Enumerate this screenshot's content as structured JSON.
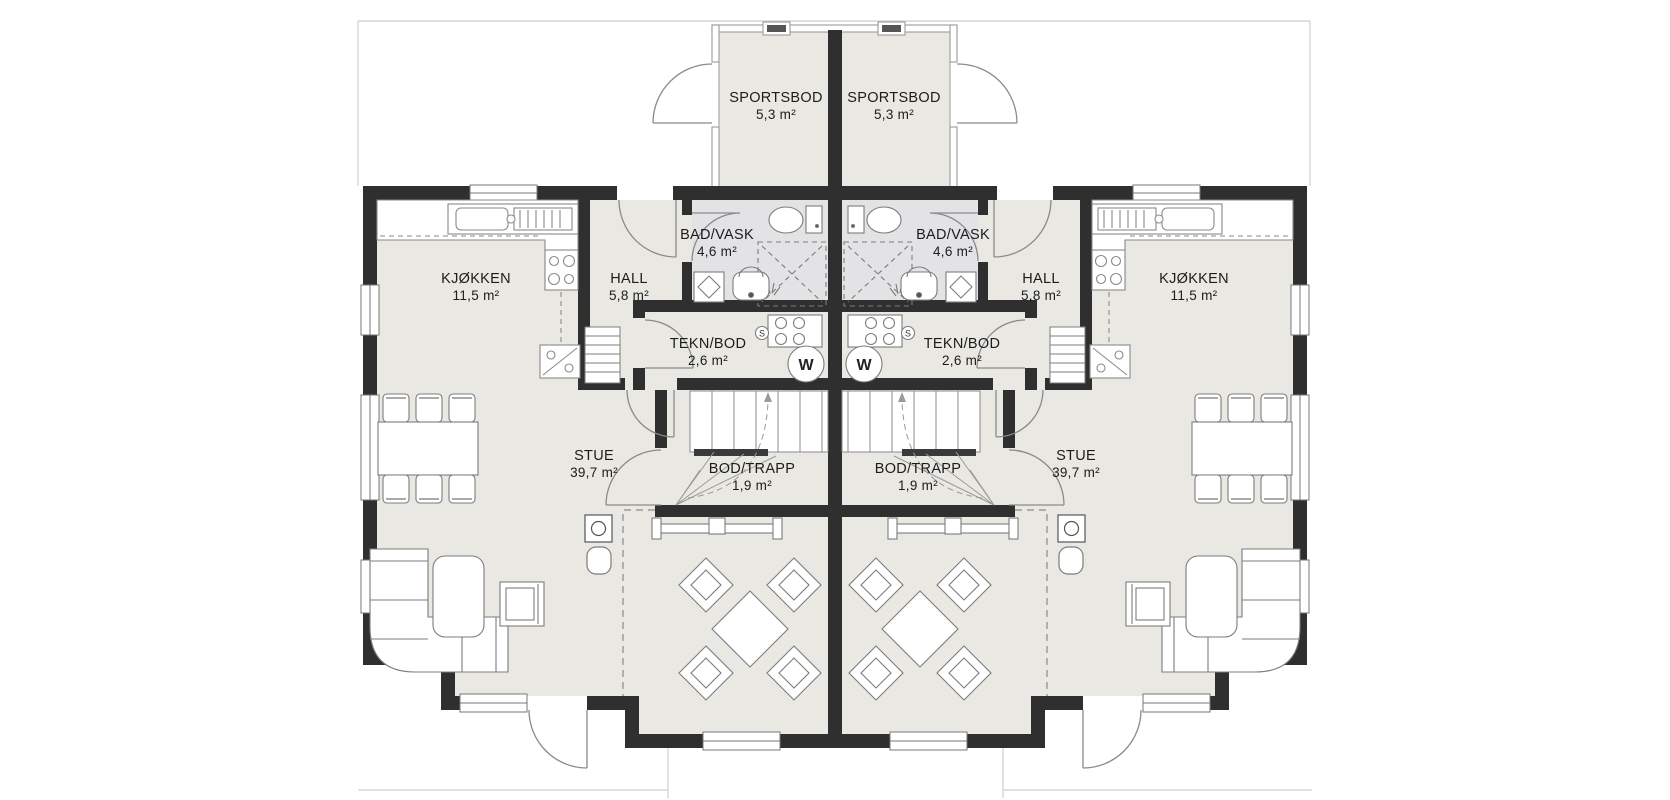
{
  "plan_type": "duplex-floor-plan",
  "units": [
    {
      "side": "left",
      "rooms": [
        {
          "name": "SPORTSBOD",
          "area": "5,3 m²"
        },
        {
          "name": "BAD/VASK",
          "area": "4,6 m²"
        },
        {
          "name": "HALL",
          "area": "5,8 m²"
        },
        {
          "name": "KJØKKEN",
          "area": "11,5 m²"
        },
        {
          "name": "TEKN/BOD",
          "area": "2,6 m²"
        },
        {
          "name": "BOD/TRAPP",
          "area": "1,9 m²"
        },
        {
          "name": "STUE",
          "area": "39,7 m²"
        }
      ]
    },
    {
      "side": "right",
      "rooms": [
        {
          "name": "SPORTSBOD",
          "area": "5,3 m²"
        },
        {
          "name": "BAD/VASK",
          "area": "4,6 m²"
        },
        {
          "name": "HALL",
          "area": "5,8 m²"
        },
        {
          "name": "KJØKKEN",
          "area": "11,5 m²"
        },
        {
          "name": "TEKN/BOD",
          "area": "2,6 m²"
        },
        {
          "name": "BOD/TRAPP",
          "area": "1,9 m²"
        },
        {
          "name": "STUE",
          "area": "39,7 m²"
        }
      ]
    }
  ],
  "symbols": {
    "water_heater": "W",
    "floor_drain": "S"
  },
  "colors": {
    "wall": "#2f2f2f",
    "floor": "#e9e8e2",
    "wet_room_floor": "#e3e3e6",
    "fixture_line": "#8a8a8a",
    "faint_outline": "#cfcfcf",
    "text": "#1c1c1c"
  }
}
